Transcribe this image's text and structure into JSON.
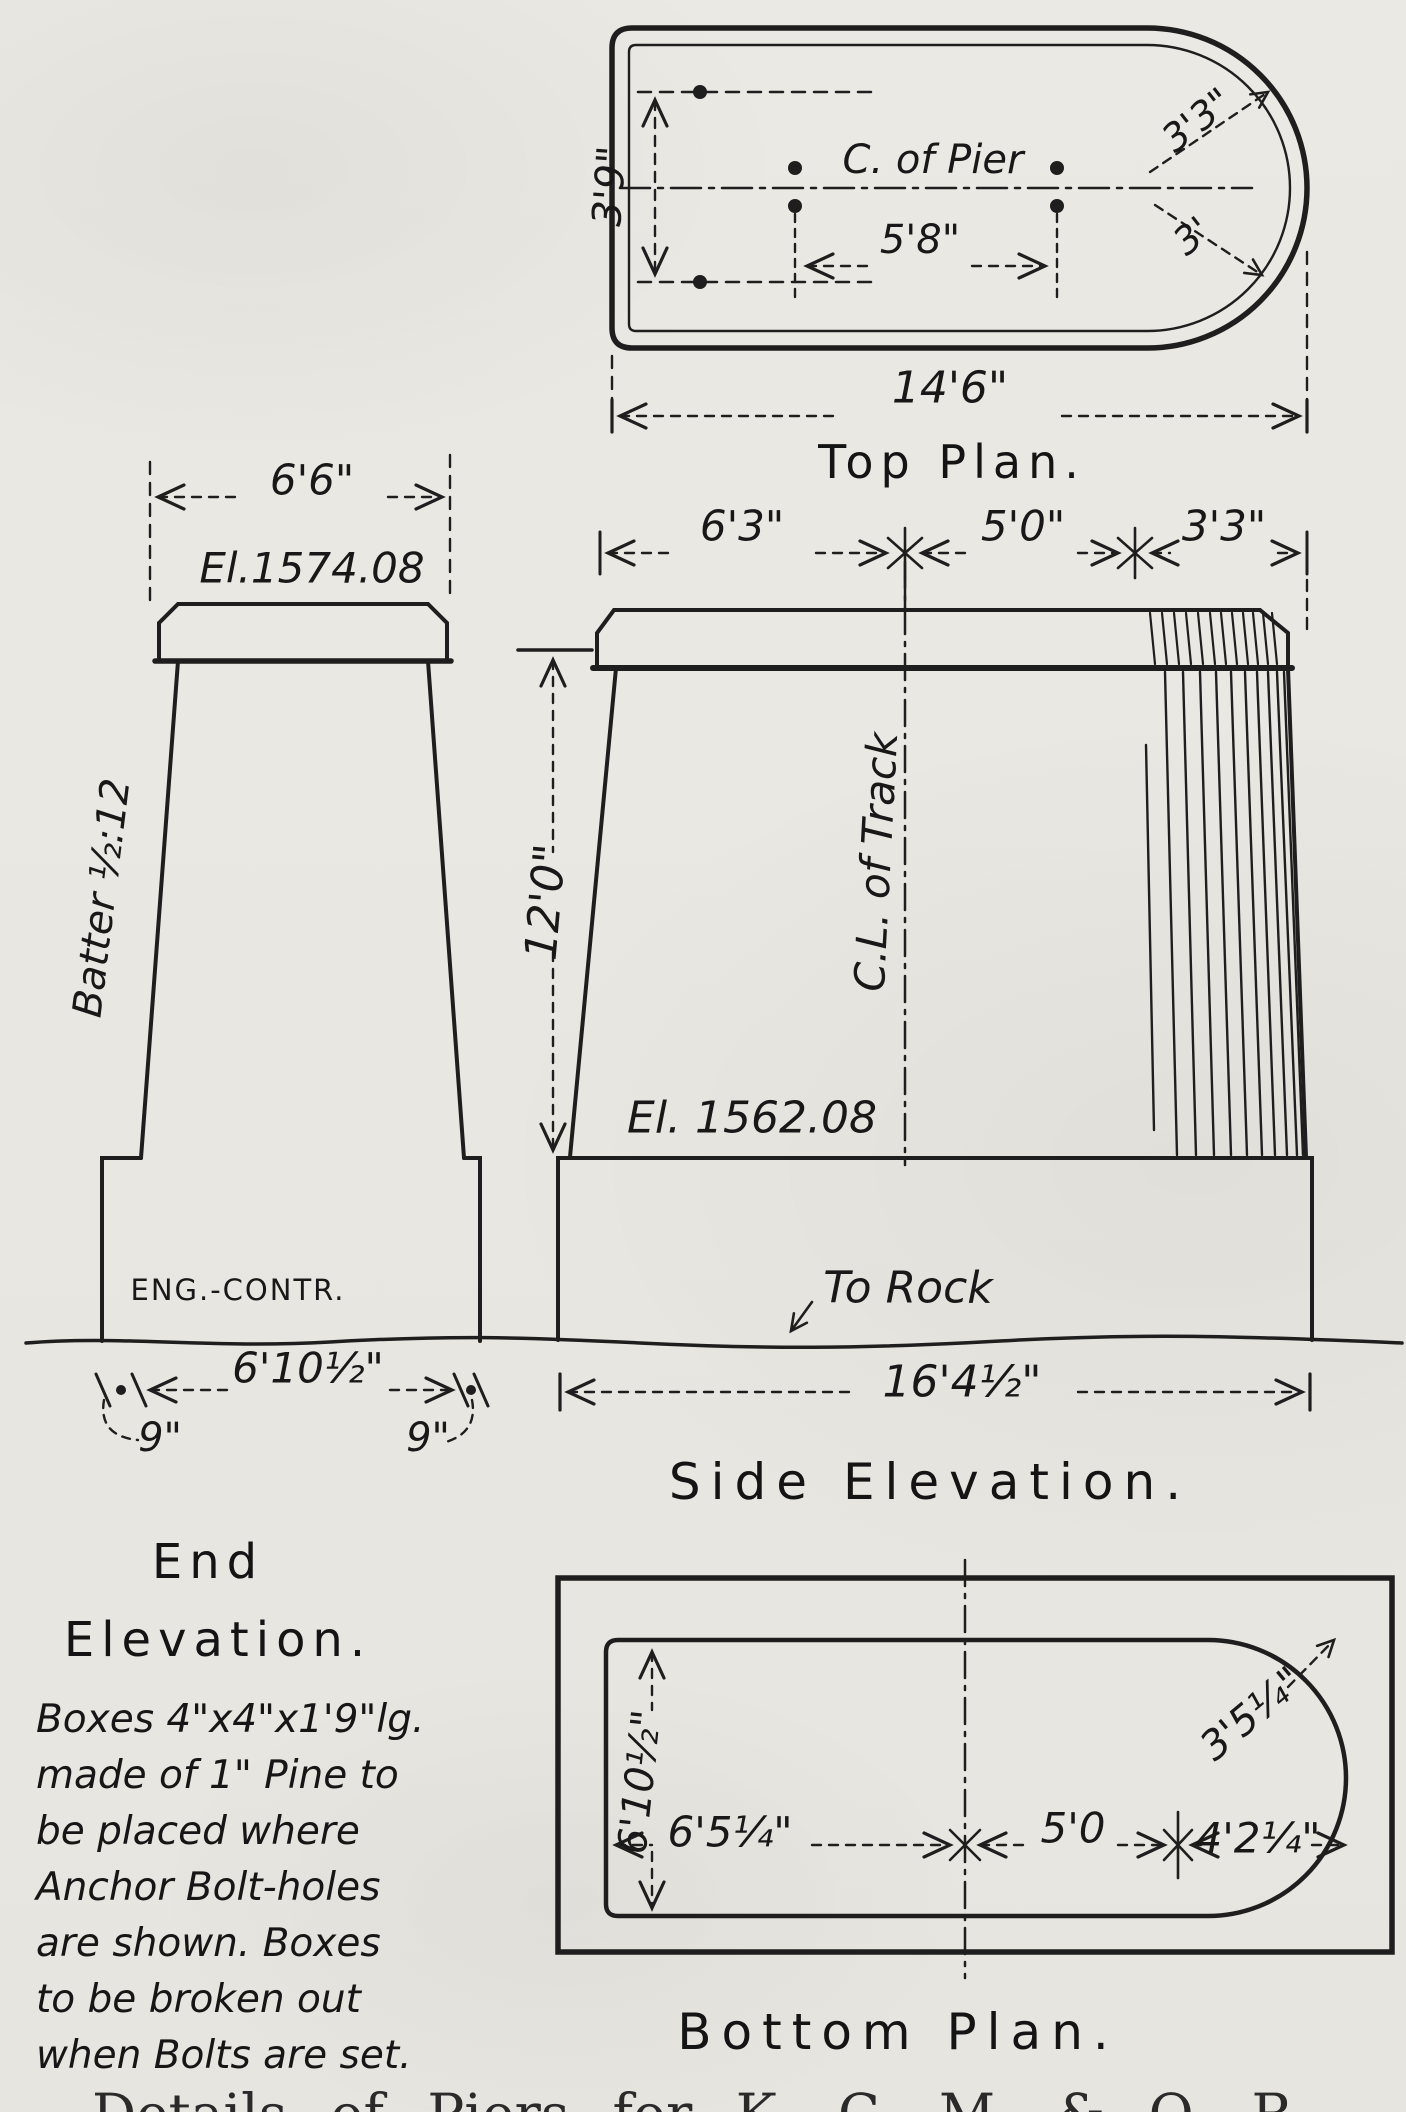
{
  "page": {
    "caption_partial": "Details of Piers for K. C. M. & O. R"
  },
  "top_plan": {
    "title": "Top Plan.",
    "center_line_label": "C. of Pier",
    "dim_overall_length": "14'6\"",
    "dim_bolt_spacing": "5'8\"",
    "dim_bolt_row_spacing": "3'9\"",
    "dim_radius_outer": "3'3\"",
    "dim_radius_inner": "3'"
  },
  "end_elevation": {
    "title_line1": "End",
    "title_line2": "Elevation.",
    "dim_top_width": "6'6\"",
    "elevation_top": "El.1574.08",
    "batter_label": "Batter ½:12",
    "footing_label": "ENG.-CONTR.",
    "dim_base_width": "6'10½\"",
    "dim_footing_offset_left": "9\"",
    "dim_footing_offset_right": "9\""
  },
  "side_elevation": {
    "title": "Side Elevation.",
    "dim_top_left": "6'3\"",
    "dim_top_middle": "5'0\"",
    "dim_top_right": "3'3\"",
    "dim_height": "12'0\"",
    "track_center_label": "C.L. of Track",
    "elevation_bottom": "El. 1562.08",
    "to_rock_label": "To Rock",
    "dim_footing_width": "16'4½\""
  },
  "bottom_plan": {
    "title": "Bottom Plan.",
    "dim_vertical": "6'10½\"",
    "dim_left": "6'5¼\"",
    "dim_middle": "5'0",
    "dim_right": "4'2¼\"",
    "dim_radius": "3'5¼\""
  },
  "note": {
    "lines": [
      "Boxes 4\"x4\"x1'9\"lg.",
      "made of 1\" Pine to",
      "be placed where",
      "Anchor Bolt-holes",
      "are shown. Boxes",
      "to be broken out",
      "when Bolts are set."
    ]
  }
}
